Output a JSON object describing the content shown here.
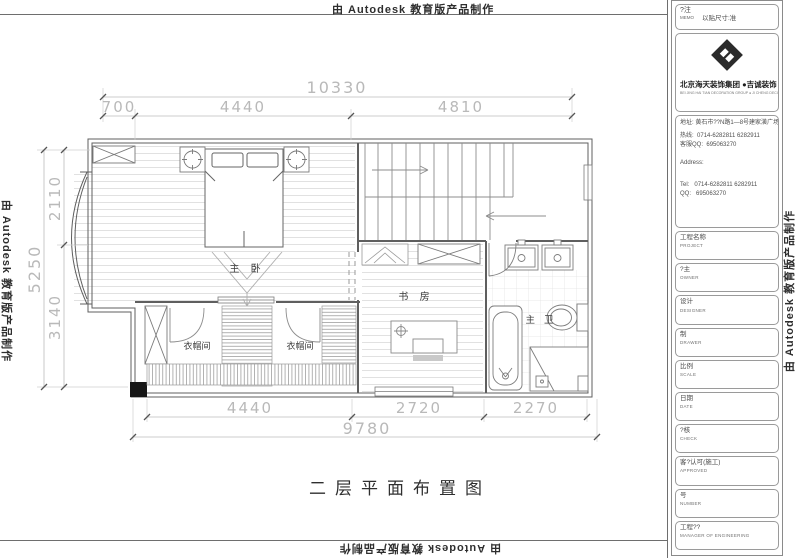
{
  "stamp": {
    "text": "由 Autodesk 教育版产品制作"
  },
  "titleblock": {
    "memo_cn": "?注",
    "memo_en": "MEMO",
    "memo_note": "以贴尺寸:准",
    "company_cn": "北京海天装饰集团 ●吉诚装饰",
    "company_en": "BEI JING HAI TIAN DECORATION GROUP ● JI CHENG DECORATION",
    "address_label": "地址:",
    "address_value": "黄石市??N路1—8号建家潢广场",
    "hotline_label": "热线:",
    "hotline_value": "0714-6282811  6282911",
    "qq_label": "客服QQ:",
    "qq_value": "695063270",
    "address_en_label": "Address:",
    "tel_label": "Tel:",
    "tel_value": "0714-6282811  6282911",
    "qq_en_label": "QQ:",
    "qq_en_value": "695063270",
    "fields": [
      {
        "cn": "工程名称",
        "en": "PROJECT"
      },
      {
        "cn": "?主",
        "en": "OWNER"
      },
      {
        "cn": "设计",
        "en": "DESIGNER"
      },
      {
        "cn": "制",
        "en": "DRAWER"
      },
      {
        "cn": "比例",
        "en": "SCALE"
      },
      {
        "cn": "日期",
        "en": "DATE"
      },
      {
        "cn": "?核",
        "en": "CHECK"
      },
      {
        "cn": "客?认可(施工)",
        "en": "APPROVED"
      },
      {
        "cn": "号",
        "en": "NUMBER"
      },
      {
        "cn": "工程??",
        "en": "MANAGER OF ENGINEERING"
      }
    ]
  },
  "plan": {
    "title": "二层平面布置图",
    "rooms": {
      "master_bedroom": "主 卧",
      "study": "书 房",
      "master_bath": "主 卫",
      "cloakroom_left": "衣帽间",
      "cloakroom_right": "衣帽间"
    },
    "dims": {
      "top_total": "10330",
      "top_segments": [
        "700",
        "4440",
        "4810"
      ],
      "left_total": "5250",
      "left_segments": [
        "2110",
        "3140"
      ],
      "bottom_segments": [
        "4440",
        "2720",
        "2270"
      ],
      "bottom_total": "9780"
    }
  }
}
